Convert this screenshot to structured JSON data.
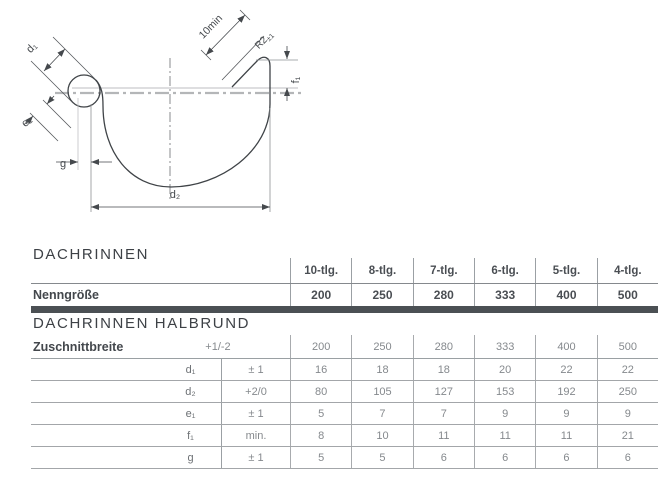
{
  "drawing": {
    "labels": {
      "d1": "d₁",
      "d2": "d₂",
      "e1": "e₁",
      "f1": "f₁",
      "g": "g",
      "fold_min": "10min",
      "radius_main": "R2",
      "radius_tol": "±1"
    }
  },
  "section_dachrinnen": {
    "title": "DACHRINNEN"
  },
  "section_halbrund": {
    "title": "DACHRINNEN HALBRUND"
  },
  "header": {
    "columns": [
      "10-tlg.",
      "8-tlg.",
      "7-tlg.",
      "6-tlg.",
      "5-tlg.",
      "4-tlg."
    ]
  },
  "nenngroesse": {
    "label": "Nenngröße",
    "values": [
      "200",
      "250",
      "280",
      "333",
      "400",
      "500"
    ]
  },
  "rows": [
    {
      "label": "Zuschnittbreite",
      "symbol": "",
      "tolerance": "+1/-2",
      "values": [
        "200",
        "250",
        "280",
        "333",
        "400",
        "500"
      ]
    },
    {
      "label": "",
      "symbol": "d₁",
      "tolerance": "± 1",
      "values": [
        "16",
        "18",
        "18",
        "20",
        "22",
        "22"
      ]
    },
    {
      "label": "",
      "symbol": "d₂",
      "tolerance": "+2/0",
      "values": [
        "80",
        "105",
        "127",
        "153",
        "192",
        "250"
      ]
    },
    {
      "label": "",
      "symbol": "e₁",
      "tolerance": "± 1",
      "values": [
        "5",
        "7",
        "7",
        "9",
        "9",
        "9"
      ]
    },
    {
      "label": "",
      "symbol": "f₁",
      "tolerance": "min.",
      "values": [
        "8",
        "10",
        "11",
        "11",
        "11",
        "21"
      ]
    },
    {
      "label": "",
      "symbol": "g",
      "tolerance": "± 1",
      "values": [
        "5",
        "5",
        "6",
        "6",
        "6",
        "6"
      ]
    }
  ]
}
